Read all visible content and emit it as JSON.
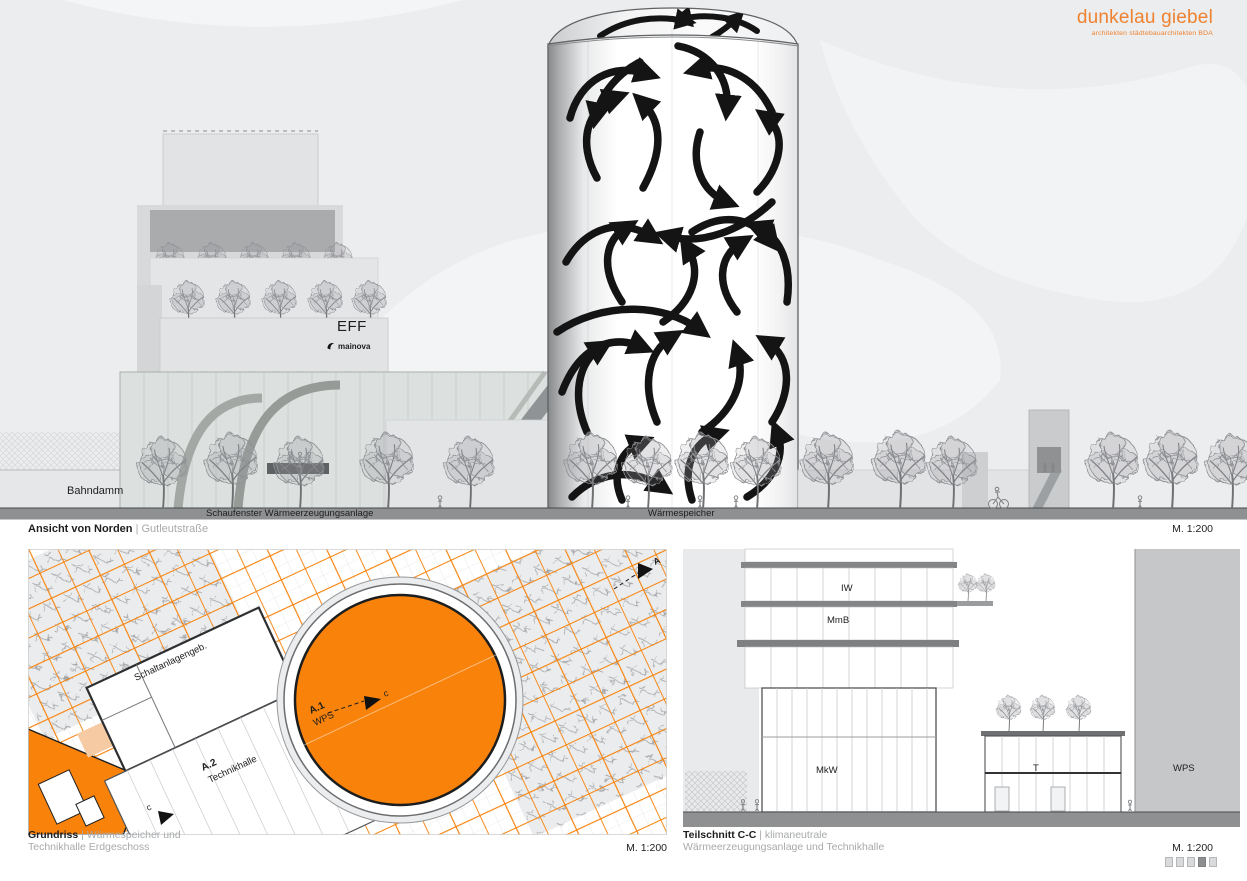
{
  "logo": {
    "title": "dunkelau giebel",
    "subtitle": "architekten städtebauarchitekten BDA"
  },
  "colors": {
    "orange": "#F8820A",
    "logo_orange": "#EE8230",
    "peach": "#F6CBA4",
    "ground_grey": "#8E9092"
  },
  "elevation": {
    "bahndamm": "Bahndamm",
    "schaufenster": "Schaufenster Wärmeerzeugungsanlage",
    "waermespeicher": "Wärmespeicher",
    "eff": "EFF",
    "mainova": "mainova",
    "title_bold": "Ansicht von Norden",
    "title_light": "| Gutleutstraße",
    "scale": "M. 1:200"
  },
  "plan": {
    "schaltanlage": "Schaltanlagengeb.",
    "a1": "A.1",
    "a1_sub": "WPS",
    "a2": "A.2",
    "a2_sub": "Technikhalle",
    "marker_c": "c",
    "marker_a": "A",
    "title_bold": "Grundriss",
    "title_light": "| Wärmespeicher und",
    "title_light2": "Technikhalle Erdgeschoss",
    "scale": "M. 1:200"
  },
  "section": {
    "iw": "IW",
    "mmb": "MmB",
    "mkw": "MkW",
    "t": "T",
    "wps": "WPS",
    "title_bold": "Teilschnitt C-C",
    "title_light": "| klimaneutrale",
    "title_light2": "Wärmeerzeugungsanlage und Technikhalle",
    "scale": "M. 1:200",
    "pager_total": 5,
    "pager_active": 4
  }
}
